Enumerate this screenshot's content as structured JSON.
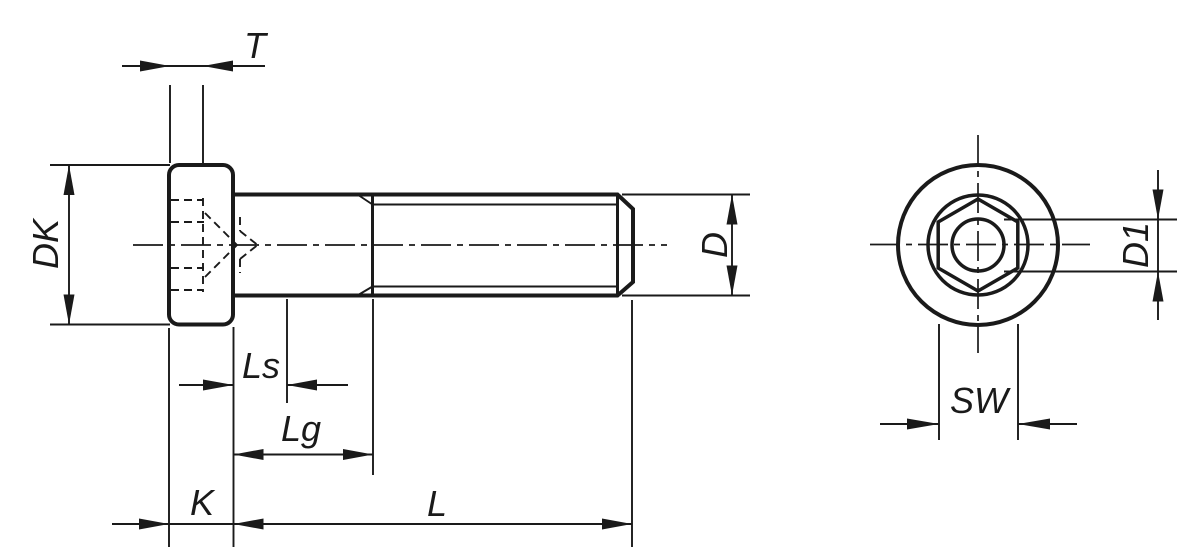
{
  "colors": {
    "line": "#1a1a1a",
    "background": "#ffffff"
  },
  "views": {
    "side": {
      "labels": {
        "t": "T",
        "dk": "DK",
        "ls": "Ls",
        "lg": "Lg",
        "k": "K",
        "l": "L",
        "d": "D"
      }
    },
    "end": {
      "labels": {
        "d1": "D1",
        "sw": "SW"
      }
    }
  }
}
